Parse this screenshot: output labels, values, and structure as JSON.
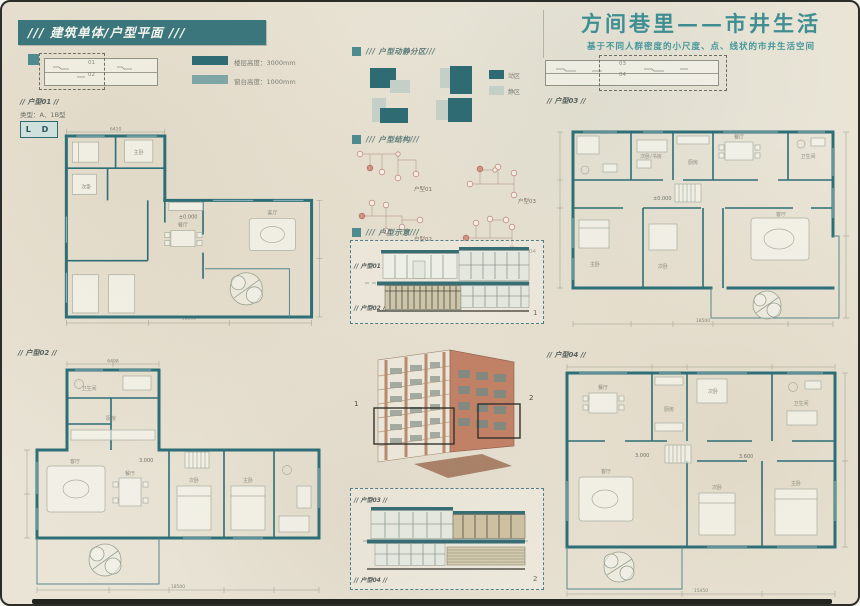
{
  "header": {
    "label": "/// 建筑单体/户型平面 ///"
  },
  "title": {
    "main": "方间巷里——市井生活",
    "subtitle": "基于不同人群密度的小尺度、点、线状的市井生活空间"
  },
  "legend": {
    "items": [
      {
        "label": "楼层高度：3000mm"
      },
      {
        "label": "窗台高度：1000mm"
      }
    ]
  },
  "keyplans": {
    "left": {
      "top": "01",
      "bottom": "02"
    },
    "right": {
      "top": "03",
      "bottom": "04"
    }
  },
  "sections": {
    "zoning": {
      "title": "/// 户型动静分区///",
      "legend": [
        {
          "label": "动区"
        },
        {
          "label": "静区"
        }
      ]
    },
    "structure": {
      "title": "/// 户型结构///",
      "items": [
        {
          "label": "户型01"
        },
        {
          "label": "户型02"
        },
        {
          "label": "户型03"
        },
        {
          "label": "户型04"
        }
      ]
    },
    "schematic": {
      "title": "/// 户型示意///",
      "box1": {
        "top_label": "// 户型01 //",
        "bottom_label": "// 户型02 //",
        "index": "1"
      },
      "box2": {
        "top_label": "// 户型03 //",
        "bottom_label": "// 户型04 //",
        "index": "2"
      },
      "axon_tags": {
        "left": "1",
        "right": "2"
      }
    }
  },
  "plans": {
    "p1": {
      "label": "// 户型01 //",
      "type_note": "类型：A、1B型",
      "badge": "L D",
      "level": "±0.000",
      "dim_top": "6420",
      "dim_bottom": "18500",
      "rooms": {
        "dining": "餐厅",
        "living": "客厅",
        "bed": "次卧",
        "master": "主卧"
      }
    },
    "p2": {
      "label": "// 户型02 //",
      "level": "3.000",
      "dim_top": "6498",
      "dim_bottom": "18500",
      "rooms": {
        "kitchen": "厨房",
        "bath": "卫生间",
        "living": "客厅",
        "dining": "餐厅",
        "bed": "次卧",
        "master": "主卧"
      }
    },
    "p3": {
      "label": "// 户型03 //",
      "level": "±0.000",
      "dim_bottom": "18500",
      "rooms": {
        "study": "次卧/书房",
        "kitchen": "厨房",
        "dining": "餐厅",
        "bath": "卫生间",
        "master": "主卧",
        "bed": "次卧",
        "living": "客厅"
      }
    },
    "p4": {
      "label": "// 户型04 //",
      "level": "3.000",
      "level2": "3.600",
      "dim_bottom": "15450",
      "rooms": {
        "dining": "餐厅",
        "kitchen": "厨房",
        "bed": "次卧",
        "bath": "卫生间",
        "living": "客厅",
        "master": "主卧",
        "bed2": "次卧"
      }
    }
  },
  "colors": {
    "teal_dark": "#2e6b72",
    "teal_header": "#3b767d",
    "sage_light": "#c3cfc7",
    "terracotta": "#c08166",
    "title_teal": "#3f8e91",
    "parchment": "#e9e4d6"
  }
}
